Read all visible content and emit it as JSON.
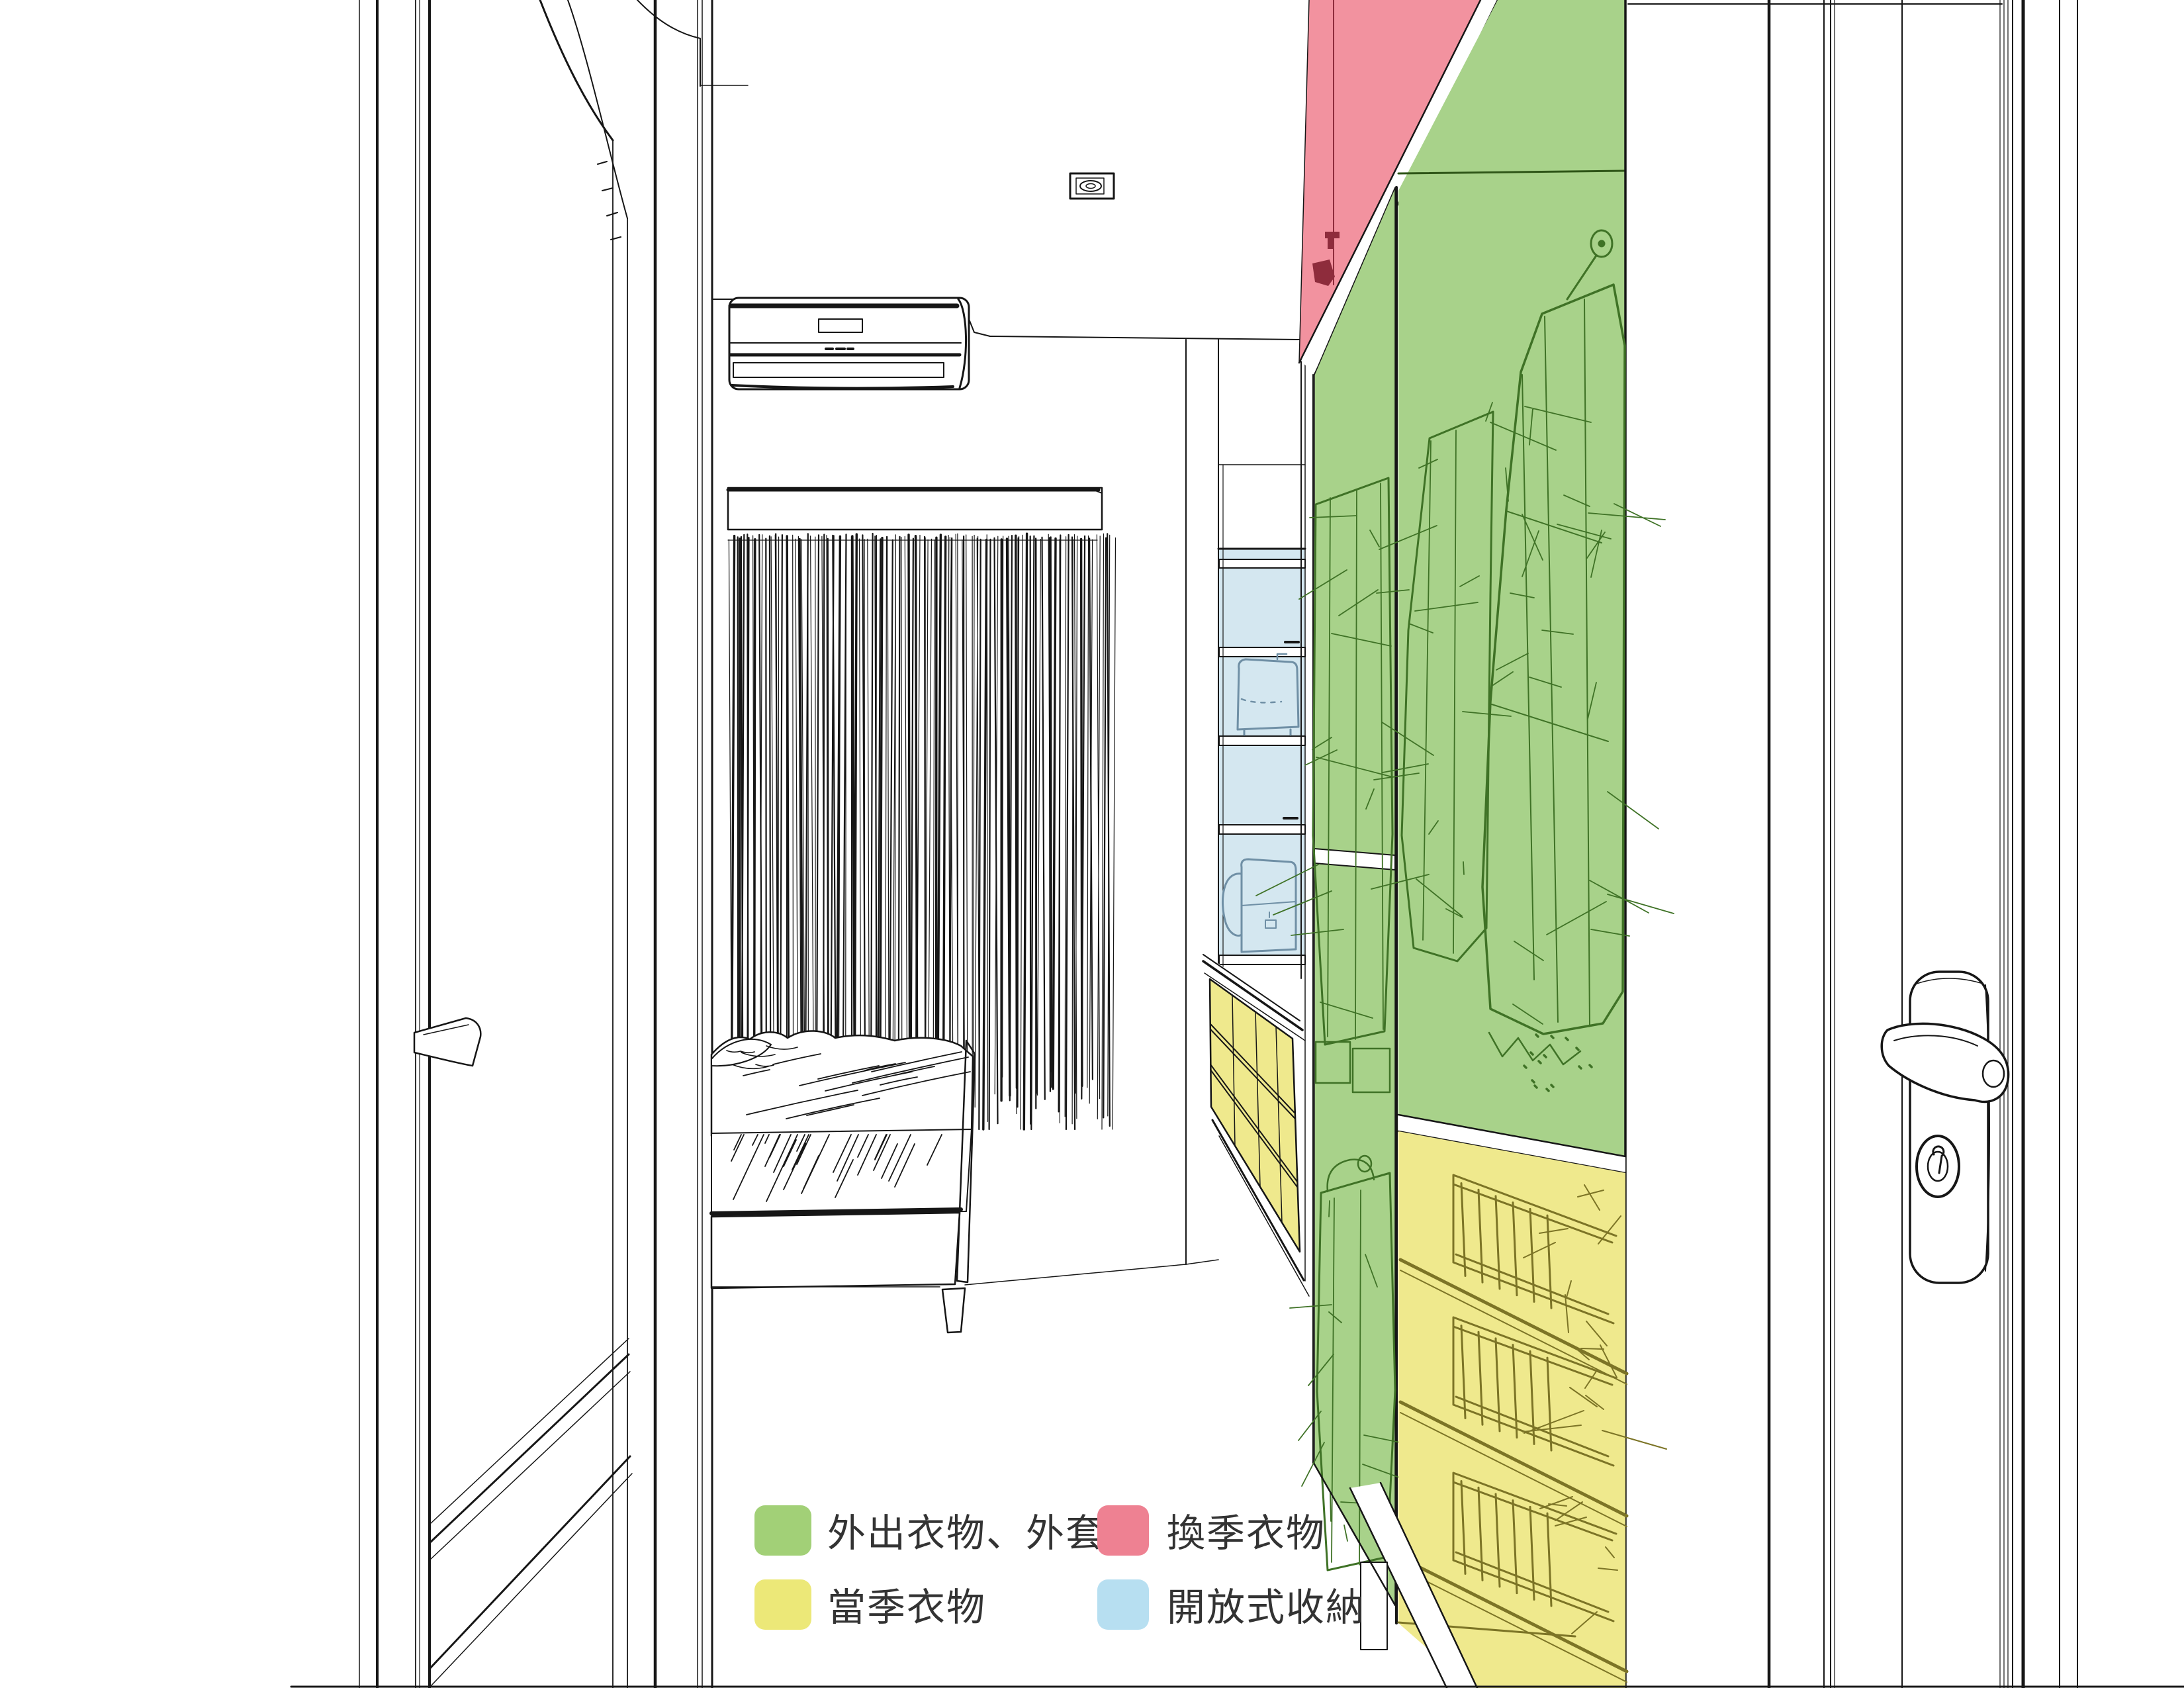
{
  "legend": {
    "items": [
      {
        "id": "outing",
        "label": "外出衣物、外套",
        "color": "#a2d077"
      },
      {
        "id": "season-change",
        "label": "換季衣物",
        "color": "#ee8192"
      },
      {
        "id": "current-season",
        "label": "當季衣物",
        "color": "#ece878"
      },
      {
        "id": "open-storage",
        "label": "開放式收納",
        "color": "#b7dff1"
      }
    ]
  },
  "palette": {
    "line": "#161616",
    "legend_text": "#333333",
    "outing_zone": "#a8d28a",
    "outing_sketch": "#3f7226",
    "seasonal_zone": "#f2929f",
    "seasonal_sketch": "#8e2c3c",
    "current_zone": "#efe98d",
    "current_sketch": "#7c7426",
    "open_zone": "#d4e7f0",
    "open_sketch": "#6f8fa5"
  }
}
